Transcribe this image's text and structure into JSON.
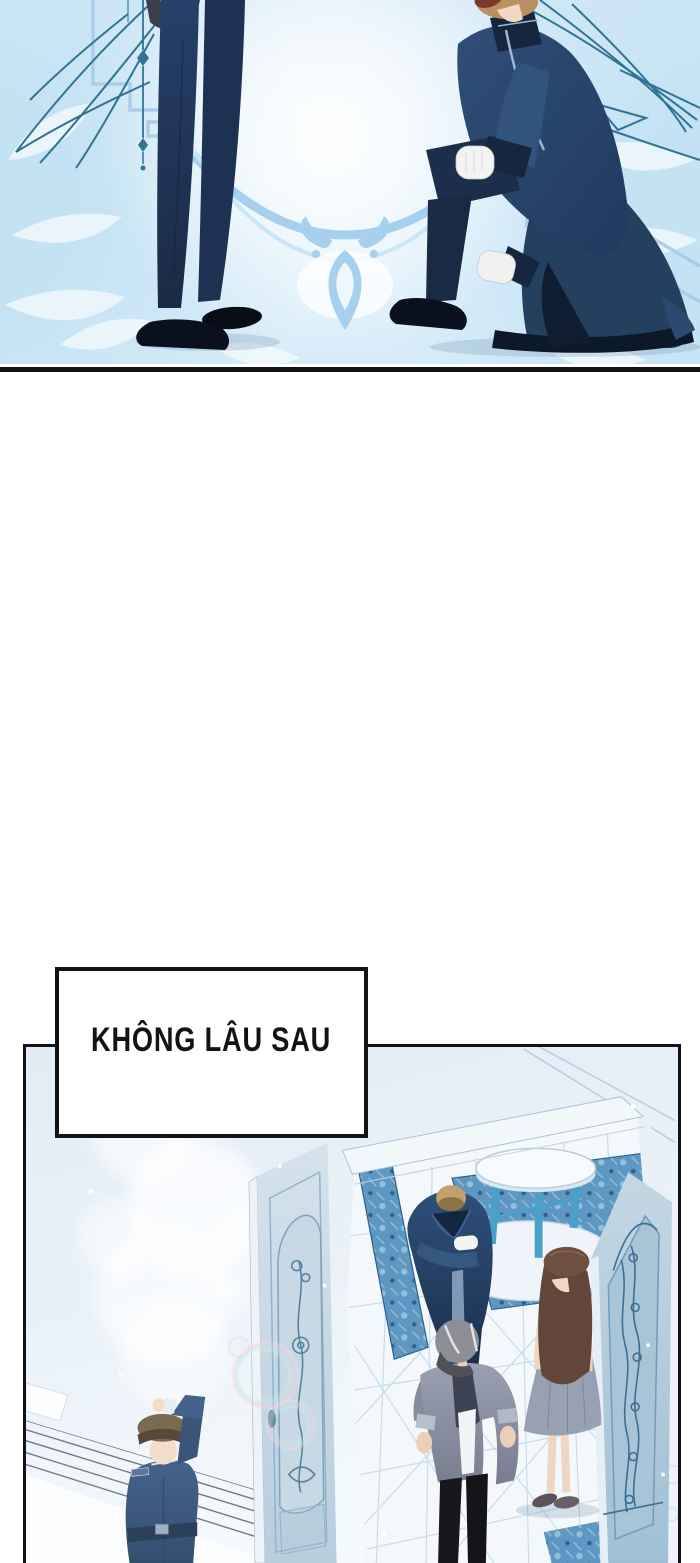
{
  "caption": {
    "text": "KHÔNG LÂU SAU"
  },
  "colors": {
    "ink": "#131317",
    "paper": "#ffffff",
    "sky": "#ddeffa",
    "sky_deep": "#c3e2f4",
    "frame_blue": "#aacbe9",
    "swag_blue": "#a6d0ee",
    "swag_light": "#c9e5f7",
    "teal_line": "#2f7492",
    "leaf_white": "#f3fafd",
    "navy": "#24405f",
    "navy_dark": "#16263e",
    "navy_deeper": "#0d1929",
    "navy_light": "#31537d",
    "piping": "#9db9d6",
    "shoe_black": "#0a101d",
    "skin": "#f2d8c2",
    "hair_tan": "#bb9060",
    "hair_maroon": "#7a3a2a",
    "panel_bg": "#e9f1f8",
    "door_light": "#d5e2ec",
    "door_mid": "#b8cedd",
    "door_dark": "#9fc0d4",
    "door_edge_light": "#edf3f8",
    "carve_teal": "#56849f",
    "carve_dark": "#3c6e92",
    "room_white": "#f4f8fb",
    "lattice_blue": "#bcd9ea",
    "carpet_blue": "#5d97c2",
    "carpet_dark": "#2f5f8e",
    "carpet_light": "#8fc0de",
    "table_teal": "#4aa0c8",
    "hair_brown": "#63463a",
    "hair_gray": "#8d8d96",
    "gray_jacket": "#8e94a4",
    "lapel_dark": "#3c4252",
    "shirt_white": "#f2f4f6",
    "pants_black": "#17171d",
    "skirt_gray": "#98a1b3",
    "band_blue": "#8a93b0",
    "guard_blue": "#45628a",
    "guard_dark": "#2b4059",
    "cap_brown": "#7a6a52",
    "ledge_line": "#5b6675",
    "shadow_blue": "rgba(120,150,180,0.28)"
  }
}
